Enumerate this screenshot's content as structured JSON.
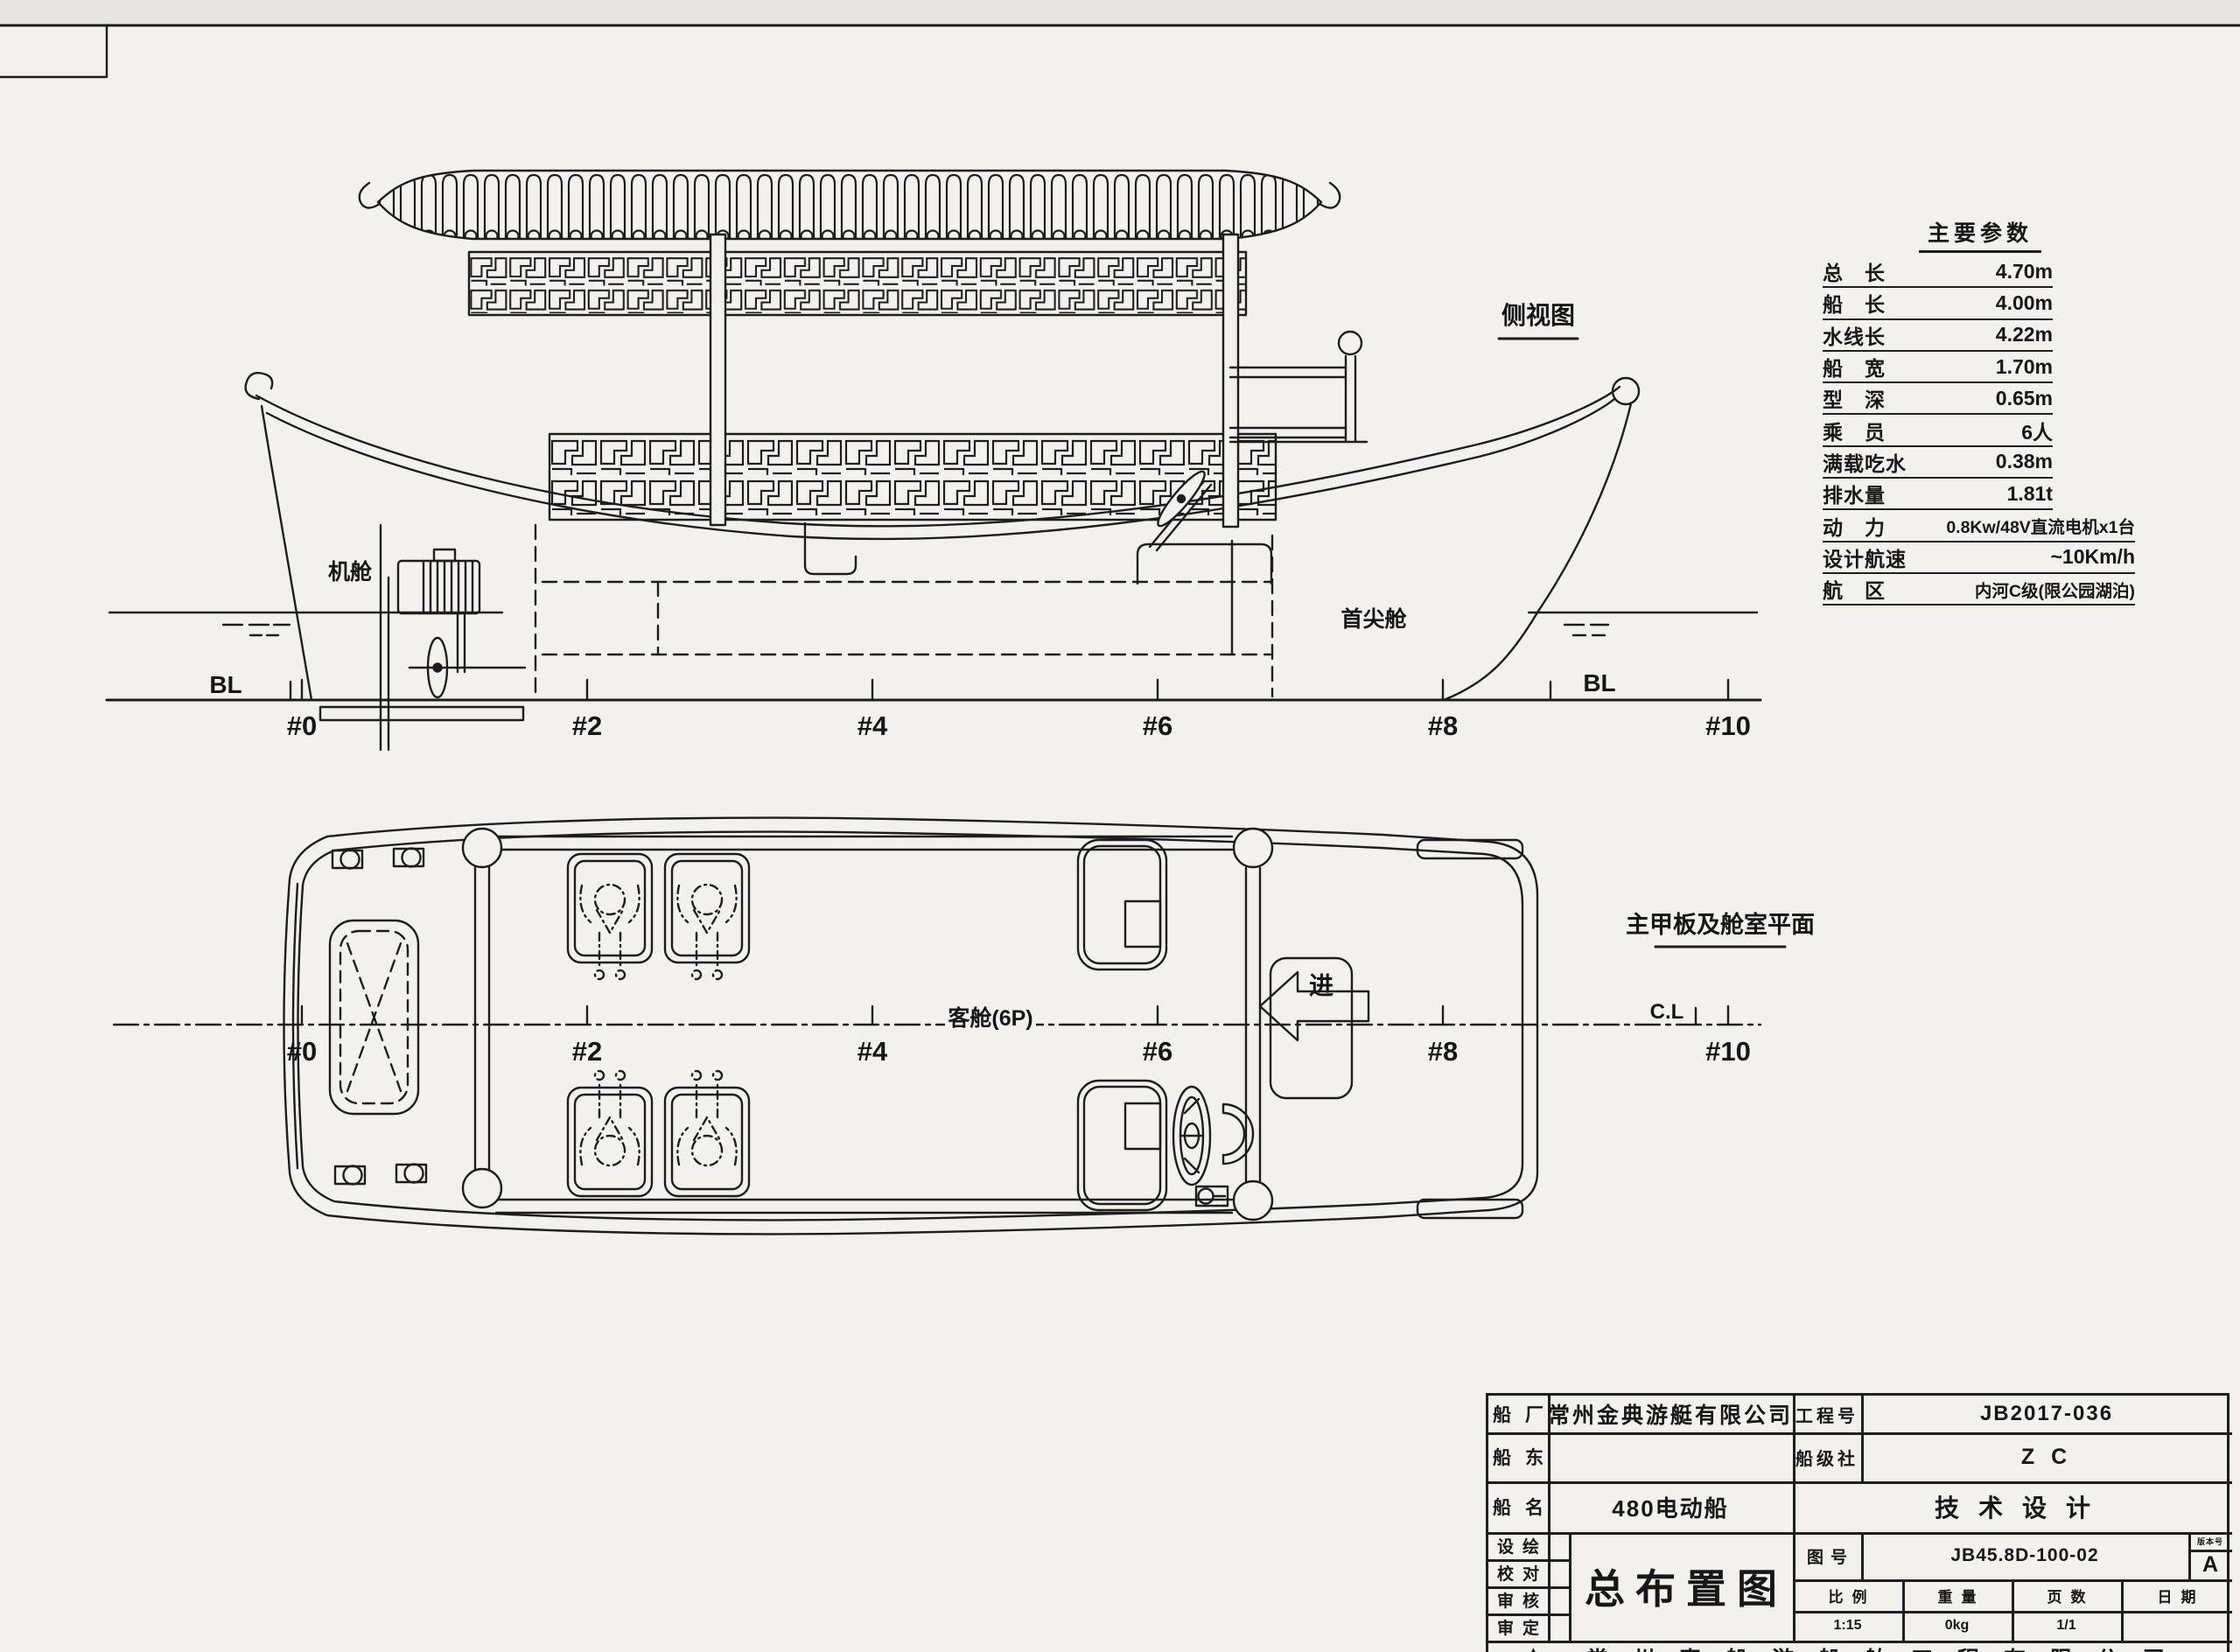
{
  "colors": {
    "paper": "#f3f1ed",
    "ink": "#1d1d1d"
  },
  "stations": [
    "#0",
    "#2",
    "#4",
    "#6",
    "#8",
    "#10"
  ],
  "side_view": {
    "title": "侧视图",
    "engine_room": "机舱",
    "fore_peak": "首尖舱",
    "bl": "BL"
  },
  "plan_view": {
    "title": "主甲板及舱室平面",
    "cabin": "客舱(6P)",
    "enter": "进",
    "cl": "C.L"
  },
  "params": {
    "title": "主要参数",
    "rows": [
      {
        "label": "总　长",
        "value": "4.70m"
      },
      {
        "label": "船　长",
        "value": "4.00m"
      },
      {
        "label": "水线长",
        "value": "4.22m"
      },
      {
        "label": "船　宽",
        "value": "1.70m"
      },
      {
        "label": "型　深",
        "value": "0.65m"
      },
      {
        "label": "乘　员",
        "value": "6人"
      },
      {
        "label": "满载吃水",
        "value": "0.38m"
      },
      {
        "label": "排水量",
        "value": "1.81t"
      },
      {
        "label": "动　力",
        "value": "0.8Kw/48V直流电机x1台"
      },
      {
        "label": "设计航速",
        "value": "~10Km/h"
      },
      {
        "label": "航　区",
        "value": "内河C级(限公园湖泊)"
      }
    ]
  },
  "title_block": {
    "shipyard_label": "船厂",
    "shipyard": "常州金典游艇有限公司",
    "project_label": "工程号",
    "project_no": "JB2017-036",
    "owner_label": "船东",
    "owner": "",
    "class_label": "船级社",
    "class_society": "Z C",
    "name_label": "船名",
    "ship_name": "480电动船",
    "stage": "技术设计",
    "design_label": "设绘",
    "check_label": "校对",
    "review_label": "审核",
    "approve_label": "审定",
    "drawing_title": "总布置图",
    "drawing_no_label": "图号",
    "drawing_no": "JB45.8D-100-02",
    "revision_label": "版本号",
    "revision": "A",
    "scale_label": "比例",
    "scale": "1:15",
    "weight_label": "重量",
    "weight": "0kg",
    "pages_label": "页数",
    "pages": "1/1",
    "date_label": "日期",
    "date": "",
    "footer": "常州真船游船舶工程有限公司"
  }
}
